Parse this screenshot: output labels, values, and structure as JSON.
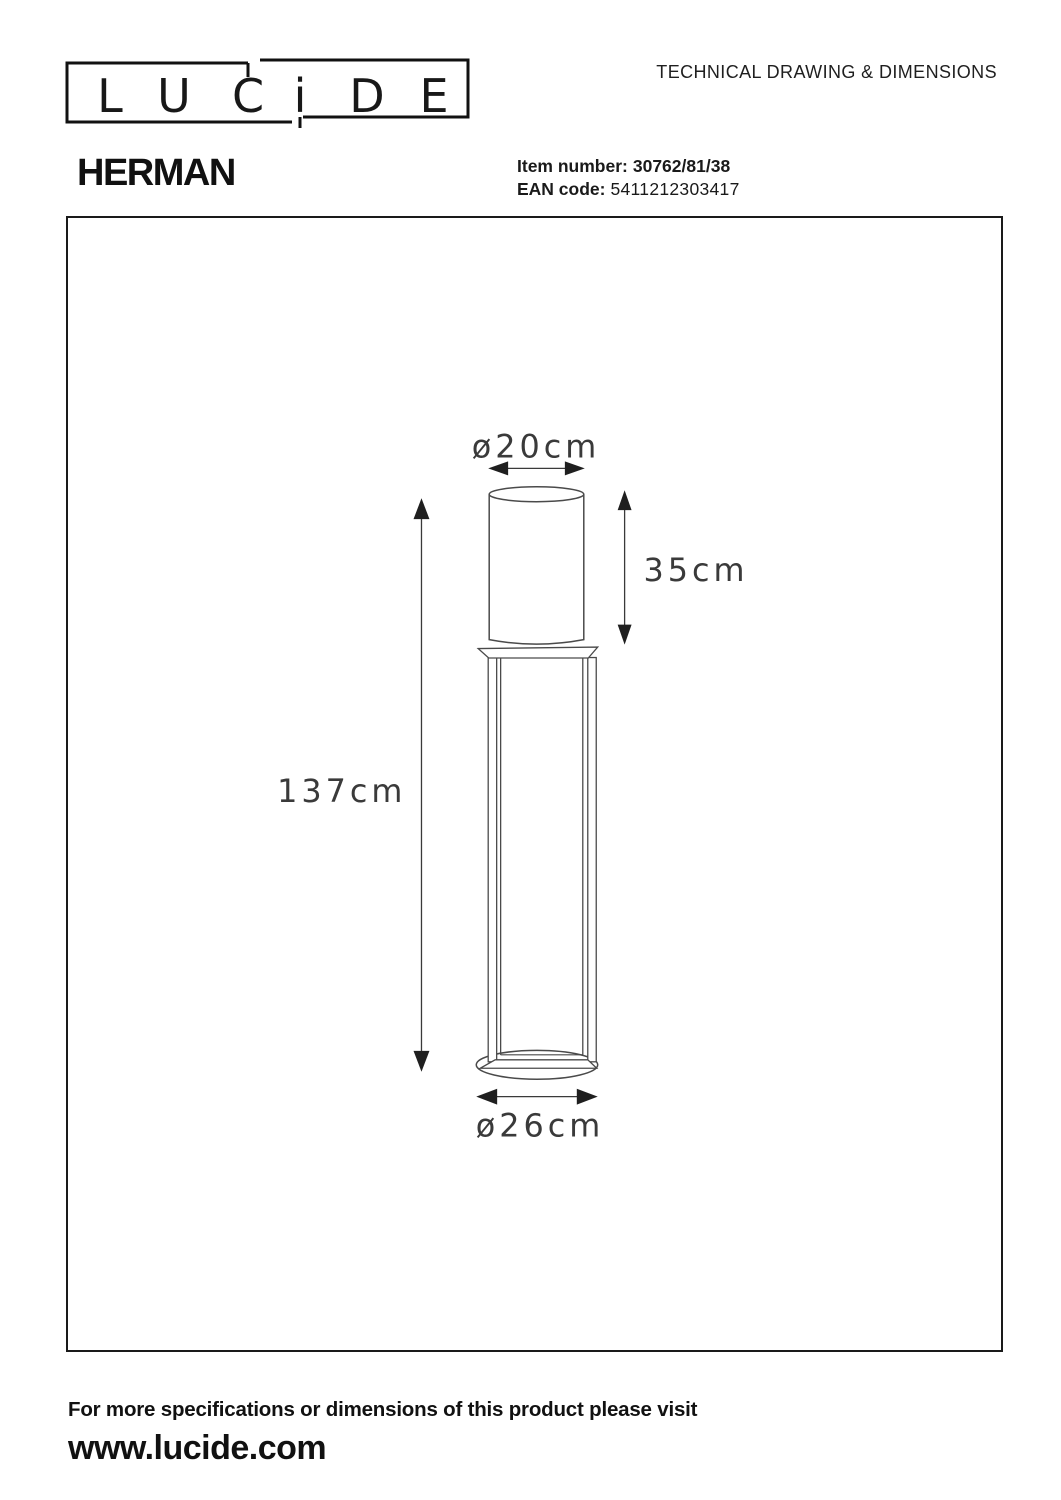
{
  "header": {
    "logo_letters": [
      "L",
      "U",
      "C",
      "i",
      "D",
      "E"
    ],
    "doc_title": "TECHNICAL DRAWING & DIMENSIONS",
    "product_name": "HERMAN",
    "item_number_label": "Item number:",
    "item_number_value": "30762/81/38",
    "ean_label": "EAN code:",
    "ean_value": "5411212303417"
  },
  "drawing": {
    "dim_top_diameter": "ø20cm",
    "dim_shade_height": "35cm",
    "dim_total_height": "137cm",
    "dim_base_diameter": "ø26cm"
  },
  "footer": {
    "note": "For more specifications or dimensions of this product please visit",
    "website": "www.lucide.com"
  },
  "colors": {
    "ink": "#1a1a1a",
    "drawing_line": "#4a4a4a",
    "dimension_label": "#3a3a3a"
  }
}
